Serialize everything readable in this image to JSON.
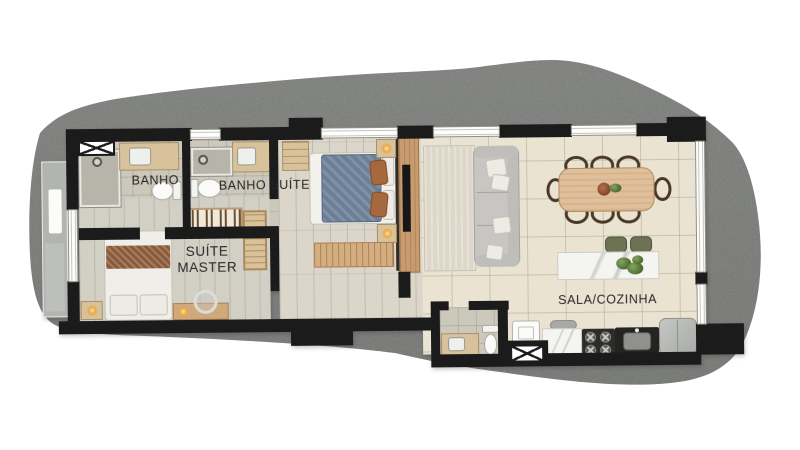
{
  "scene": {
    "type": "apartment floor plan, rendered top view",
    "background": "#ffffff",
    "terrain_color": "#b6b8b5",
    "wall_color": "#1b1b1b"
  },
  "labels": {
    "bath": "BANHO",
    "suite_bath": "BANHO SUÍTE",
    "master_suite_l1": "SUÍTE",
    "master_suite_l2": "MASTER",
    "living_kitchen": "SALA/COZINHA"
  },
  "rooms": [
    "BANHO",
    "BANHO SUÍTE",
    "SUÍTE MASTER",
    "SALA/COZINHA"
  ],
  "furniture": [
    "shower",
    "bathroom-vanity",
    "toilet",
    "hanger-closet",
    "shelf-wardrobe",
    "double-bed-master",
    "nightstand-lamp",
    "round-mirror",
    "console",
    "double-bed-blue",
    "dresser",
    "tv-panel",
    "sofa",
    "rug",
    "dining-table",
    "dining-chairs",
    "kitchen-island",
    "stools",
    "cooktop",
    "kitchen-sink-counter",
    "fridge",
    "laundry-basin",
    "utility-shaft",
    "ac-unit"
  ],
  "colors": {
    "tile_floor": "#eae3d2",
    "plank_floor": "#dbd6c9",
    "bath_floor": "#ccc8bc",
    "wood": "#cfa87b",
    "bed_blue": "#6b7f97",
    "throw_brown": "#8a5a39",
    "sofa_gray": "#c7c6c2",
    "marble": "#f4f4f1",
    "stool_olive": "#6e7254",
    "lamp_glow": "#eaa83f"
  }
}
